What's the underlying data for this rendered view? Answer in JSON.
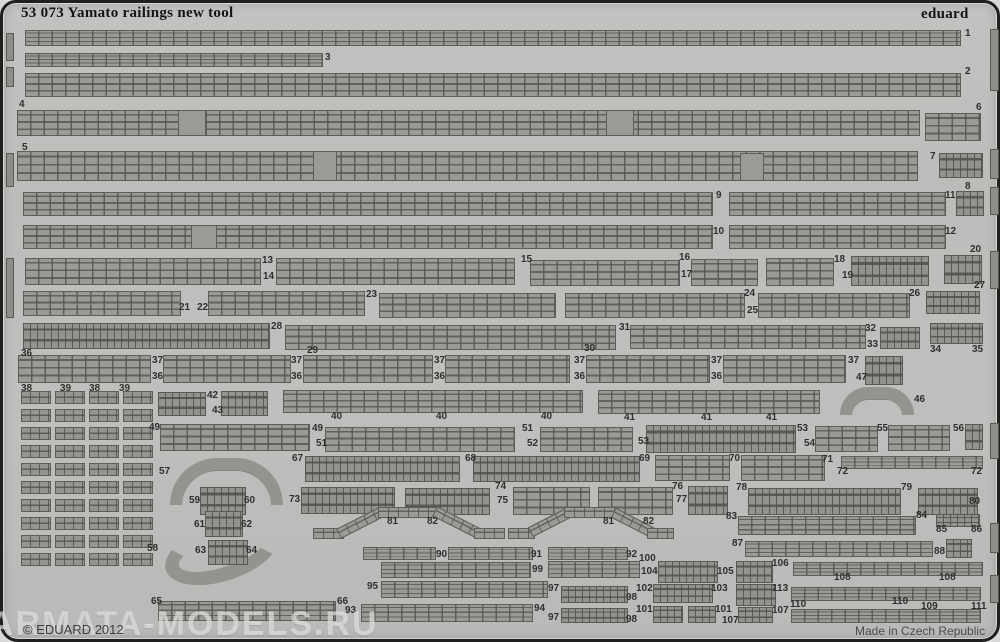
{
  "sheet": {
    "title": "53 073 Yamato railings new tool",
    "brand": "eduard",
    "copyright": "© EDUARD 2012",
    "made_in": "Made in Czech Republic",
    "watermark": "ARMATA-MODELS.RU"
  },
  "colors": {
    "sheet_base": "#bcbcba",
    "part_fill": "#9b9b95",
    "part_outline": "#5e5e59",
    "border": "#1f1f1d",
    "text": "#2f2f2d"
  },
  "grid": {
    "x": 18,
    "y": 388,
    "cols": 4,
    "rows": 10,
    "cw": 30,
    "ch": 13,
    "sx": 34,
    "sy": 18
  },
  "pieces": [
    {
      "x": 22,
      "y": 27,
      "w": 936,
      "h": 16,
      "k": "rail"
    },
    {
      "x": 22,
      "y": 50,
      "w": 298,
      "h": 14,
      "k": "rail"
    },
    {
      "x": 22,
      "y": 70,
      "w": 936,
      "h": 24,
      "k": "rail"
    },
    {
      "x": 14,
      "y": 107,
      "w": 903,
      "h": 26,
      "k": "rail"
    },
    {
      "x": 922,
      "y": 110,
      "w": 56,
      "h": 28,
      "k": "rail"
    },
    {
      "x": 14,
      "y": 148,
      "w": 901,
      "h": 30,
      "k": "rail"
    },
    {
      "x": 936,
      "y": 150,
      "w": 44,
      "h": 25,
      "k": "dense"
    },
    {
      "x": 175,
      "y": 107,
      "w": 28,
      "h": 26,
      "k": "tab"
    },
    {
      "x": 603,
      "y": 107,
      "w": 28,
      "h": 26,
      "k": "tab"
    },
    {
      "x": 310,
      "y": 148,
      "w": 24,
      "h": 30,
      "k": "tab"
    },
    {
      "x": 737,
      "y": 150,
      "w": 24,
      "h": 28,
      "k": "tab"
    },
    {
      "x": 20,
      "y": 189,
      "w": 690,
      "h": 24,
      "k": "rail"
    },
    {
      "x": 726,
      "y": 189,
      "w": 217,
      "h": 24,
      "k": "rail"
    },
    {
      "x": 953,
      "y": 188,
      "w": 28,
      "h": 25,
      "k": "dense"
    },
    {
      "x": 20,
      "y": 222,
      "w": 690,
      "h": 24,
      "k": "rail"
    },
    {
      "x": 188,
      "y": 222,
      "w": 26,
      "h": 24,
      "k": "tab"
    },
    {
      "x": 726,
      "y": 222,
      "w": 217,
      "h": 24,
      "k": "rail"
    },
    {
      "x": 941,
      "y": 252,
      "w": 38,
      "h": 29,
      "k": "dense"
    },
    {
      "x": 22,
      "y": 255,
      "w": 236,
      "h": 27,
      "k": "rail"
    },
    {
      "x": 273,
      "y": 255,
      "w": 239,
      "h": 27,
      "k": "rail"
    },
    {
      "x": 527,
      "y": 257,
      "w": 150,
      "h": 26,
      "k": "rail"
    },
    {
      "x": 688,
      "y": 256,
      "w": 67,
      "h": 27,
      "k": "rail"
    },
    {
      "x": 763,
      "y": 255,
      "w": 68,
      "h": 28,
      "k": "rail"
    },
    {
      "x": 848,
      "y": 253,
      "w": 78,
      "h": 30,
      "k": "dense"
    },
    {
      "x": 20,
      "y": 288,
      "w": 158,
      "h": 25,
      "k": "rail"
    },
    {
      "x": 205,
      "y": 288,
      "w": 157,
      "h": 25,
      "k": "rail"
    },
    {
      "x": 376,
      "y": 290,
      "w": 177,
      "h": 25,
      "k": "rail"
    },
    {
      "x": 562,
      "y": 290,
      "w": 180,
      "h": 25,
      "k": "rail"
    },
    {
      "x": 755,
      "y": 290,
      "w": 152,
      "h": 25,
      "k": "rail"
    },
    {
      "x": 923,
      "y": 288,
      "w": 54,
      "h": 23,
      "k": "dense"
    },
    {
      "x": 20,
      "y": 320,
      "w": 247,
      "h": 26,
      "k": "dense"
    },
    {
      "x": 282,
      "y": 322,
      "w": 331,
      "h": 25,
      "k": "rail"
    },
    {
      "x": 627,
      "y": 322,
      "w": 236,
      "h": 24,
      "k": "rail"
    },
    {
      "x": 877,
      "y": 324,
      "w": 40,
      "h": 22,
      "k": "dense"
    },
    {
      "x": 927,
      "y": 320,
      "w": 53,
      "h": 21,
      "k": "dense"
    },
    {
      "x": 15,
      "y": 352,
      "w": 133,
      "h": 28,
      "k": "rail"
    },
    {
      "x": 160,
      "y": 352,
      "w": 128,
      "h": 28,
      "k": "rail"
    },
    {
      "x": 300,
      "y": 352,
      "w": 130,
      "h": 28,
      "k": "rail"
    },
    {
      "x": 442,
      "y": 352,
      "w": 125,
      "h": 28,
      "k": "rail"
    },
    {
      "x": 583,
      "y": 352,
      "w": 124,
      "h": 28,
      "k": "rail"
    },
    {
      "x": 720,
      "y": 352,
      "w": 123,
      "h": 28,
      "k": "rail"
    },
    {
      "x": 862,
      "y": 353,
      "w": 38,
      "h": 29,
      "k": "dense"
    },
    {
      "x": 155,
      "y": 389,
      "w": 48,
      "h": 24,
      "k": "dense"
    },
    {
      "x": 218,
      "y": 388,
      "w": 47,
      "h": 25,
      "k": "dense"
    },
    {
      "x": 280,
      "y": 387,
      "w": 300,
      "h": 23,
      "k": "rail"
    },
    {
      "x": 595,
      "y": 387,
      "w": 222,
      "h": 24,
      "k": "rail"
    },
    {
      "x": 837,
      "y": 384,
      "w": 74,
      "h": 28,
      "k": "arc"
    },
    {
      "x": 157,
      "y": 421,
      "w": 150,
      "h": 27,
      "k": "rail"
    },
    {
      "x": 322,
      "y": 424,
      "w": 190,
      "h": 25,
      "k": "rail"
    },
    {
      "x": 537,
      "y": 424,
      "w": 93,
      "h": 25,
      "k": "rail"
    },
    {
      "x": 643,
      "y": 422,
      "w": 150,
      "h": 28,
      "k": "dense"
    },
    {
      "x": 812,
      "y": 423,
      "w": 63,
      "h": 26,
      "k": "rail"
    },
    {
      "x": 885,
      "y": 422,
      "w": 62,
      "h": 26,
      "k": "rail"
    },
    {
      "x": 962,
      "y": 421,
      "w": 18,
      "h": 26,
      "k": "dense"
    },
    {
      "x": 167,
      "y": 455,
      "w": 113,
      "h": 47,
      "k": "arc"
    },
    {
      "x": 302,
      "y": 453,
      "w": 155,
      "h": 26,
      "k": "dense"
    },
    {
      "x": 470,
      "y": 453,
      "w": 167,
      "h": 26,
      "k": "dense"
    },
    {
      "x": 652,
      "y": 452,
      "w": 75,
      "h": 26,
      "k": "rail"
    },
    {
      "x": 738,
      "y": 452,
      "w": 84,
      "h": 26,
      "k": "rail"
    },
    {
      "x": 838,
      "y": 453,
      "w": 142,
      "h": 13,
      "k": "rail"
    },
    {
      "x": 197,
      "y": 484,
      "w": 46,
      "h": 28,
      "k": "dense"
    },
    {
      "x": 202,
      "y": 508,
      "w": 38,
      "h": 26,
      "k": "dense"
    },
    {
      "x": 298,
      "y": 484,
      "w": 94,
      "h": 27,
      "k": "dense"
    },
    {
      "x": 402,
      "y": 485,
      "w": 85,
      "h": 27,
      "k": "dense"
    },
    {
      "x": 510,
      "y": 484,
      "w": 77,
      "h": 28,
      "k": "rail"
    },
    {
      "x": 595,
      "y": 484,
      "w": 75,
      "h": 28,
      "k": "rail"
    },
    {
      "x": 685,
      "y": 483,
      "w": 40,
      "h": 29,
      "k": "dense"
    },
    {
      "x": 745,
      "y": 485,
      "w": 153,
      "h": 27,
      "k": "dense"
    },
    {
      "x": 915,
      "y": 485,
      "w": 60,
      "h": 27,
      "k": "dense"
    },
    {
      "x": 310,
      "y": 504,
      "w": 192,
      "h": 32,
      "k": "zig"
    },
    {
      "x": 505,
      "y": 504,
      "w": 166,
      "h": 32,
      "k": "zig"
    },
    {
      "x": 735,
      "y": 513,
      "w": 178,
      "h": 19,
      "k": "rail"
    },
    {
      "x": 933,
      "y": 511,
      "w": 44,
      "h": 13,
      "k": "dense"
    },
    {
      "x": 160,
      "y": 520,
      "w": 118,
      "h": 58,
      "k": "arc2"
    },
    {
      "x": 205,
      "y": 537,
      "w": 40,
      "h": 25,
      "k": "dense"
    },
    {
      "x": 742,
      "y": 538,
      "w": 188,
      "h": 16,
      "k": "rail"
    },
    {
      "x": 943,
      "y": 536,
      "w": 26,
      "h": 19,
      "k": "dense"
    },
    {
      "x": 360,
      "y": 544,
      "w": 73,
      "h": 13,
      "k": "rail"
    },
    {
      "x": 445,
      "y": 544,
      "w": 85,
      "h": 13,
      "k": "rail"
    },
    {
      "x": 545,
      "y": 544,
      "w": 80,
      "h": 13,
      "k": "rail"
    },
    {
      "x": 378,
      "y": 559,
      "w": 150,
      "h": 16,
      "k": "rail"
    },
    {
      "x": 545,
      "y": 558,
      "w": 92,
      "h": 17,
      "k": "rail"
    },
    {
      "x": 655,
      "y": 558,
      "w": 60,
      "h": 22,
      "k": "dense"
    },
    {
      "x": 733,
      "y": 558,
      "w": 37,
      "h": 22,
      "k": "dense"
    },
    {
      "x": 790,
      "y": 559,
      "w": 190,
      "h": 14,
      "k": "rail"
    },
    {
      "x": 378,
      "y": 578,
      "w": 167,
      "h": 17,
      "k": "rail"
    },
    {
      "x": 558,
      "y": 583,
      "w": 67,
      "h": 17,
      "k": "dense"
    },
    {
      "x": 650,
      "y": 581,
      "w": 60,
      "h": 19,
      "k": "dense"
    },
    {
      "x": 733,
      "y": 581,
      "w": 40,
      "h": 22,
      "k": "dense"
    },
    {
      "x": 788,
      "y": 584,
      "w": 190,
      "h": 14,
      "k": "rail"
    },
    {
      "x": 155,
      "y": 598,
      "w": 178,
      "h": 20,
      "k": "rail"
    },
    {
      "x": 358,
      "y": 601,
      "w": 172,
      "h": 18,
      "k": "rail"
    },
    {
      "x": 558,
      "y": 605,
      "w": 67,
      "h": 15,
      "k": "dense"
    },
    {
      "x": 650,
      "y": 603,
      "w": 30,
      "h": 17,
      "k": "dense"
    },
    {
      "x": 685,
      "y": 603,
      "w": 28,
      "h": 17,
      "k": "dense"
    },
    {
      "x": 735,
      "y": 604,
      "w": 35,
      "h": 16,
      "k": "dense"
    },
    {
      "x": 788,
      "y": 606,
      "w": 190,
      "h": 14,
      "k": "rail"
    },
    {
      "x": 3,
      "y": 30,
      "w": 8,
      "h": 28,
      "k": "solid"
    },
    {
      "x": 3,
      "y": 64,
      "w": 8,
      "h": 20,
      "k": "solid"
    },
    {
      "x": 3,
      "y": 150,
      "w": 8,
      "h": 34,
      "k": "solid"
    },
    {
      "x": 3,
      "y": 255,
      "w": 8,
      "h": 60,
      "k": "solid"
    },
    {
      "x": 987,
      "y": 26,
      "w": 9,
      "h": 62,
      "k": "solid"
    },
    {
      "x": 987,
      "y": 146,
      "w": 9,
      "h": 30,
      "k": "solid"
    },
    {
      "x": 987,
      "y": 184,
      "w": 9,
      "h": 28,
      "k": "solid"
    },
    {
      "x": 987,
      "y": 248,
      "w": 9,
      "h": 38,
      "k": "solid"
    },
    {
      "x": 987,
      "y": 420,
      "w": 9,
      "h": 36,
      "k": "solid"
    },
    {
      "x": 987,
      "y": 520,
      "w": 9,
      "h": 30,
      "k": "solid"
    },
    {
      "x": 987,
      "y": 572,
      "w": 9,
      "h": 28,
      "k": "solid"
    }
  ],
  "labels": [
    {
      "t": "1",
      "x": 962,
      "y": 26
    },
    {
      "t": "3",
      "x": 322,
      "y": 50
    },
    {
      "t": "2",
      "x": 962,
      "y": 64
    },
    {
      "t": "4",
      "x": 16,
      "y": 97
    },
    {
      "t": "6",
      "x": 973,
      "y": 100
    },
    {
      "t": "5",
      "x": 19,
      "y": 140
    },
    {
      "t": "7",
      "x": 927,
      "y": 149
    },
    {
      "t": "8",
      "x": 962,
      "y": 179
    },
    {
      "t": "9",
      "x": 713,
      "y": 188
    },
    {
      "t": "11",
      "x": 942,
      "y": 188
    },
    {
      "t": "10",
      "x": 710,
      "y": 224
    },
    {
      "t": "12",
      "x": 942,
      "y": 224
    },
    {
      "t": "20",
      "x": 967,
      "y": 242
    },
    {
      "t": "13",
      "x": 259,
      "y": 253
    },
    {
      "t": "14",
      "x": 260,
      "y": 269
    },
    {
      "t": "15",
      "x": 518,
      "y": 252
    },
    {
      "t": "16",
      "x": 676,
      "y": 250
    },
    {
      "t": "17",
      "x": 678,
      "y": 267
    },
    {
      "t": "18",
      "x": 831,
      "y": 252
    },
    {
      "t": "19",
      "x": 839,
      "y": 268
    },
    {
      "t": "21",
      "x": 176,
      "y": 300
    },
    {
      "t": "22",
      "x": 194,
      "y": 300
    },
    {
      "t": "23",
      "x": 363,
      "y": 287
    },
    {
      "t": "24",
      "x": 741,
      "y": 286
    },
    {
      "t": "25",
      "x": 744,
      "y": 303
    },
    {
      "t": "26",
      "x": 906,
      "y": 286
    },
    {
      "t": "27",
      "x": 971,
      "y": 278
    },
    {
      "t": "28",
      "x": 268,
      "y": 319
    },
    {
      "t": "29",
      "x": 304,
      "y": 343
    },
    {
      "t": "36",
      "x": 18,
      "y": 346
    },
    {
      "t": "30",
      "x": 581,
      "y": 341
    },
    {
      "t": "31",
      "x": 616,
      "y": 320
    },
    {
      "t": "32",
      "x": 862,
      "y": 321
    },
    {
      "t": "33",
      "x": 864,
      "y": 337
    },
    {
      "t": "34",
      "x": 927,
      "y": 342
    },
    {
      "t": "35",
      "x": 969,
      "y": 342
    },
    {
      "t": "37",
      "x": 149,
      "y": 353
    },
    {
      "t": "36",
      "x": 149,
      "y": 369
    },
    {
      "t": "37",
      "x": 288,
      "y": 353
    },
    {
      "t": "36",
      "x": 288,
      "y": 369
    },
    {
      "t": "37",
      "x": 431,
      "y": 353
    },
    {
      "t": "36",
      "x": 431,
      "y": 369
    },
    {
      "t": "37",
      "x": 571,
      "y": 353
    },
    {
      "t": "36",
      "x": 571,
      "y": 369
    },
    {
      "t": "37",
      "x": 708,
      "y": 353
    },
    {
      "t": "36",
      "x": 708,
      "y": 369
    },
    {
      "t": "37",
      "x": 845,
      "y": 353
    },
    {
      "t": "47",
      "x": 853,
      "y": 370
    },
    {
      "t": "38",
      "x": 18,
      "y": 381
    },
    {
      "t": "39",
      "x": 57,
      "y": 381
    },
    {
      "t": "38",
      "x": 86,
      "y": 381
    },
    {
      "t": "39",
      "x": 116,
      "y": 381
    },
    {
      "t": "42",
      "x": 204,
      "y": 388
    },
    {
      "t": "43",
      "x": 209,
      "y": 403
    },
    {
      "t": "40",
      "x": 328,
      "y": 409
    },
    {
      "t": "40",
      "x": 433,
      "y": 409
    },
    {
      "t": "40",
      "x": 538,
      "y": 409
    },
    {
      "t": "41",
      "x": 621,
      "y": 410
    },
    {
      "t": "41",
      "x": 698,
      "y": 410
    },
    {
      "t": "41",
      "x": 763,
      "y": 410
    },
    {
      "t": "46",
      "x": 911,
      "y": 392
    },
    {
      "t": "49",
      "x": 146,
      "y": 420
    },
    {
      "t": "49",
      "x": 309,
      "y": 421
    },
    {
      "t": "51",
      "x": 313,
      "y": 436
    },
    {
      "t": "51",
      "x": 519,
      "y": 421
    },
    {
      "t": "52",
      "x": 524,
      "y": 436
    },
    {
      "t": "53",
      "x": 635,
      "y": 434
    },
    {
      "t": "53",
      "x": 794,
      "y": 421
    },
    {
      "t": "54",
      "x": 801,
      "y": 436
    },
    {
      "t": "55",
      "x": 874,
      "y": 421
    },
    {
      "t": "56",
      "x": 950,
      "y": 421
    },
    {
      "t": "57",
      "x": 156,
      "y": 464
    },
    {
      "t": "67",
      "x": 289,
      "y": 451
    },
    {
      "t": "68",
      "x": 462,
      "y": 451
    },
    {
      "t": "69",
      "x": 636,
      "y": 451
    },
    {
      "t": "70",
      "x": 726,
      "y": 451
    },
    {
      "t": "71",
      "x": 819,
      "y": 452
    },
    {
      "t": "72",
      "x": 834,
      "y": 464
    },
    {
      "t": "72",
      "x": 968,
      "y": 464
    },
    {
      "t": "59",
      "x": 186,
      "y": 493
    },
    {
      "t": "60",
      "x": 241,
      "y": 493
    },
    {
      "t": "61",
      "x": 191,
      "y": 517
    },
    {
      "t": "62",
      "x": 238,
      "y": 517
    },
    {
      "t": "73",
      "x": 286,
      "y": 492
    },
    {
      "t": "74",
      "x": 492,
      "y": 479
    },
    {
      "t": "75",
      "x": 494,
      "y": 493
    },
    {
      "t": "76",
      "x": 669,
      "y": 479
    },
    {
      "t": "77",
      "x": 673,
      "y": 492
    },
    {
      "t": "78",
      "x": 733,
      "y": 480
    },
    {
      "t": "79",
      "x": 898,
      "y": 480
    },
    {
      "t": "80",
      "x": 966,
      "y": 494
    },
    {
      "t": "81",
      "x": 384,
      "y": 514
    },
    {
      "t": "82",
      "x": 424,
      "y": 514
    },
    {
      "t": "81",
      "x": 600,
      "y": 514
    },
    {
      "t": "82",
      "x": 640,
      "y": 514
    },
    {
      "t": "83",
      "x": 723,
      "y": 509
    },
    {
      "t": "84",
      "x": 913,
      "y": 508
    },
    {
      "t": "85",
      "x": 933,
      "y": 522
    },
    {
      "t": "86",
      "x": 968,
      "y": 522
    },
    {
      "t": "58",
      "x": 144,
      "y": 541
    },
    {
      "t": "63",
      "x": 192,
      "y": 543
    },
    {
      "t": "64",
      "x": 243,
      "y": 543
    },
    {
      "t": "87",
      "x": 729,
      "y": 536
    },
    {
      "t": "88",
      "x": 931,
      "y": 544
    },
    {
      "t": "90",
      "x": 433,
      "y": 547
    },
    {
      "t": "91",
      "x": 528,
      "y": 547
    },
    {
      "t": "92",
      "x": 623,
      "y": 547
    },
    {
      "t": "100",
      "x": 636,
      "y": 551
    },
    {
      "t": "99",
      "x": 529,
      "y": 562
    },
    {
      "t": "104",
      "x": 638,
      "y": 564
    },
    {
      "t": "105",
      "x": 714,
      "y": 564
    },
    {
      "t": "106",
      "x": 769,
      "y": 556
    },
    {
      "t": "108",
      "x": 831,
      "y": 570
    },
    {
      "t": "108",
      "x": 936,
      "y": 570
    },
    {
      "t": "95",
      "x": 364,
      "y": 579
    },
    {
      "t": "97",
      "x": 545,
      "y": 581
    },
    {
      "t": "98",
      "x": 623,
      "y": 590
    },
    {
      "t": "102",
      "x": 633,
      "y": 581
    },
    {
      "t": "103",
      "x": 708,
      "y": 581
    },
    {
      "t": "113",
      "x": 769,
      "y": 581
    },
    {
      "t": "110",
      "x": 787,
      "y": 597
    },
    {
      "t": "110",
      "x": 889,
      "y": 594
    },
    {
      "t": "109",
      "x": 918,
      "y": 599
    },
    {
      "t": "111",
      "x": 968,
      "y": 599
    },
    {
      "t": "65",
      "x": 148,
      "y": 594
    },
    {
      "t": "66",
      "x": 334,
      "y": 594
    },
    {
      "t": "93",
      "x": 342,
      "y": 603
    },
    {
      "t": "94",
      "x": 531,
      "y": 601
    },
    {
      "t": "97",
      "x": 545,
      "y": 610
    },
    {
      "t": "98",
      "x": 623,
      "y": 612
    },
    {
      "t": "101",
      "x": 633,
      "y": 602
    },
    {
      "t": "101",
      "x": 712,
      "y": 602
    },
    {
      "t": "107",
      "x": 719,
      "y": 613
    },
    {
      "t": "107",
      "x": 769,
      "y": 603
    }
  ]
}
